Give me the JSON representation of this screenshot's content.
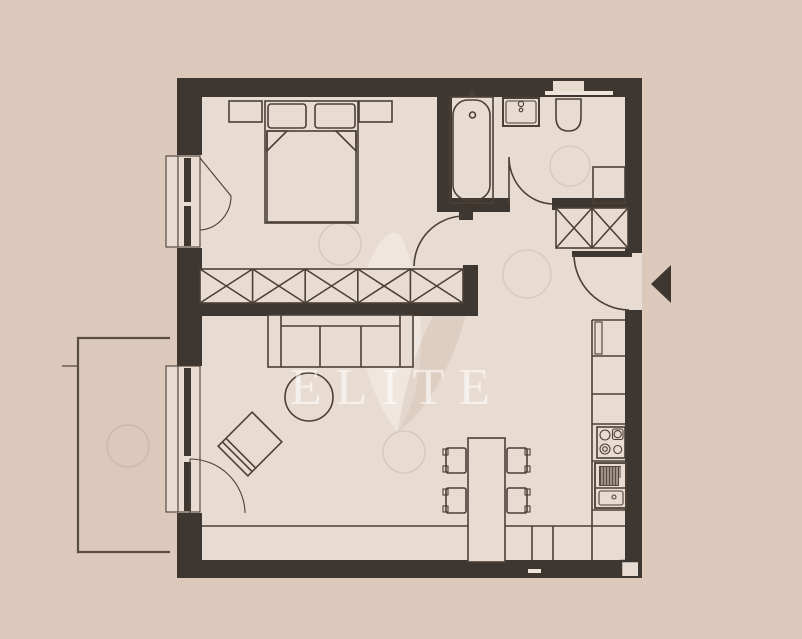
{
  "watermark": {
    "brand": "ELITE",
    "logo": "leaf-logo"
  },
  "colors": {
    "background": "#dcc9bc",
    "floor": "#e8dbd1",
    "wall": "#3e3731",
    "line": "#4b4037",
    "balcony_line": "#5a4c41",
    "watermark": "rgba(255,255,255,0.58)"
  },
  "plan_symbols": [
    "double-bed",
    "pillow",
    "blanket-fold",
    "nightstand",
    "wardrobe-x-unit",
    "bathtub",
    "washbasin",
    "wall-hung-toilet",
    "appliance-niche",
    "bathroom-window",
    "entry-closet-x-unit",
    "entrance-door-swing",
    "entrance-arrow",
    "interior-door-swing",
    "window-casement-swing",
    "balcony-outline",
    "balcony-door",
    "sofa",
    "coffee-table",
    "armchair",
    "dining-table",
    "dining-chair",
    "kitchen-counter",
    "refrigerator",
    "cooktop-4-burners",
    "kitchen-sink-with-drainer",
    "ceiling-light-circle",
    "bottom-counter-bench"
  ]
}
